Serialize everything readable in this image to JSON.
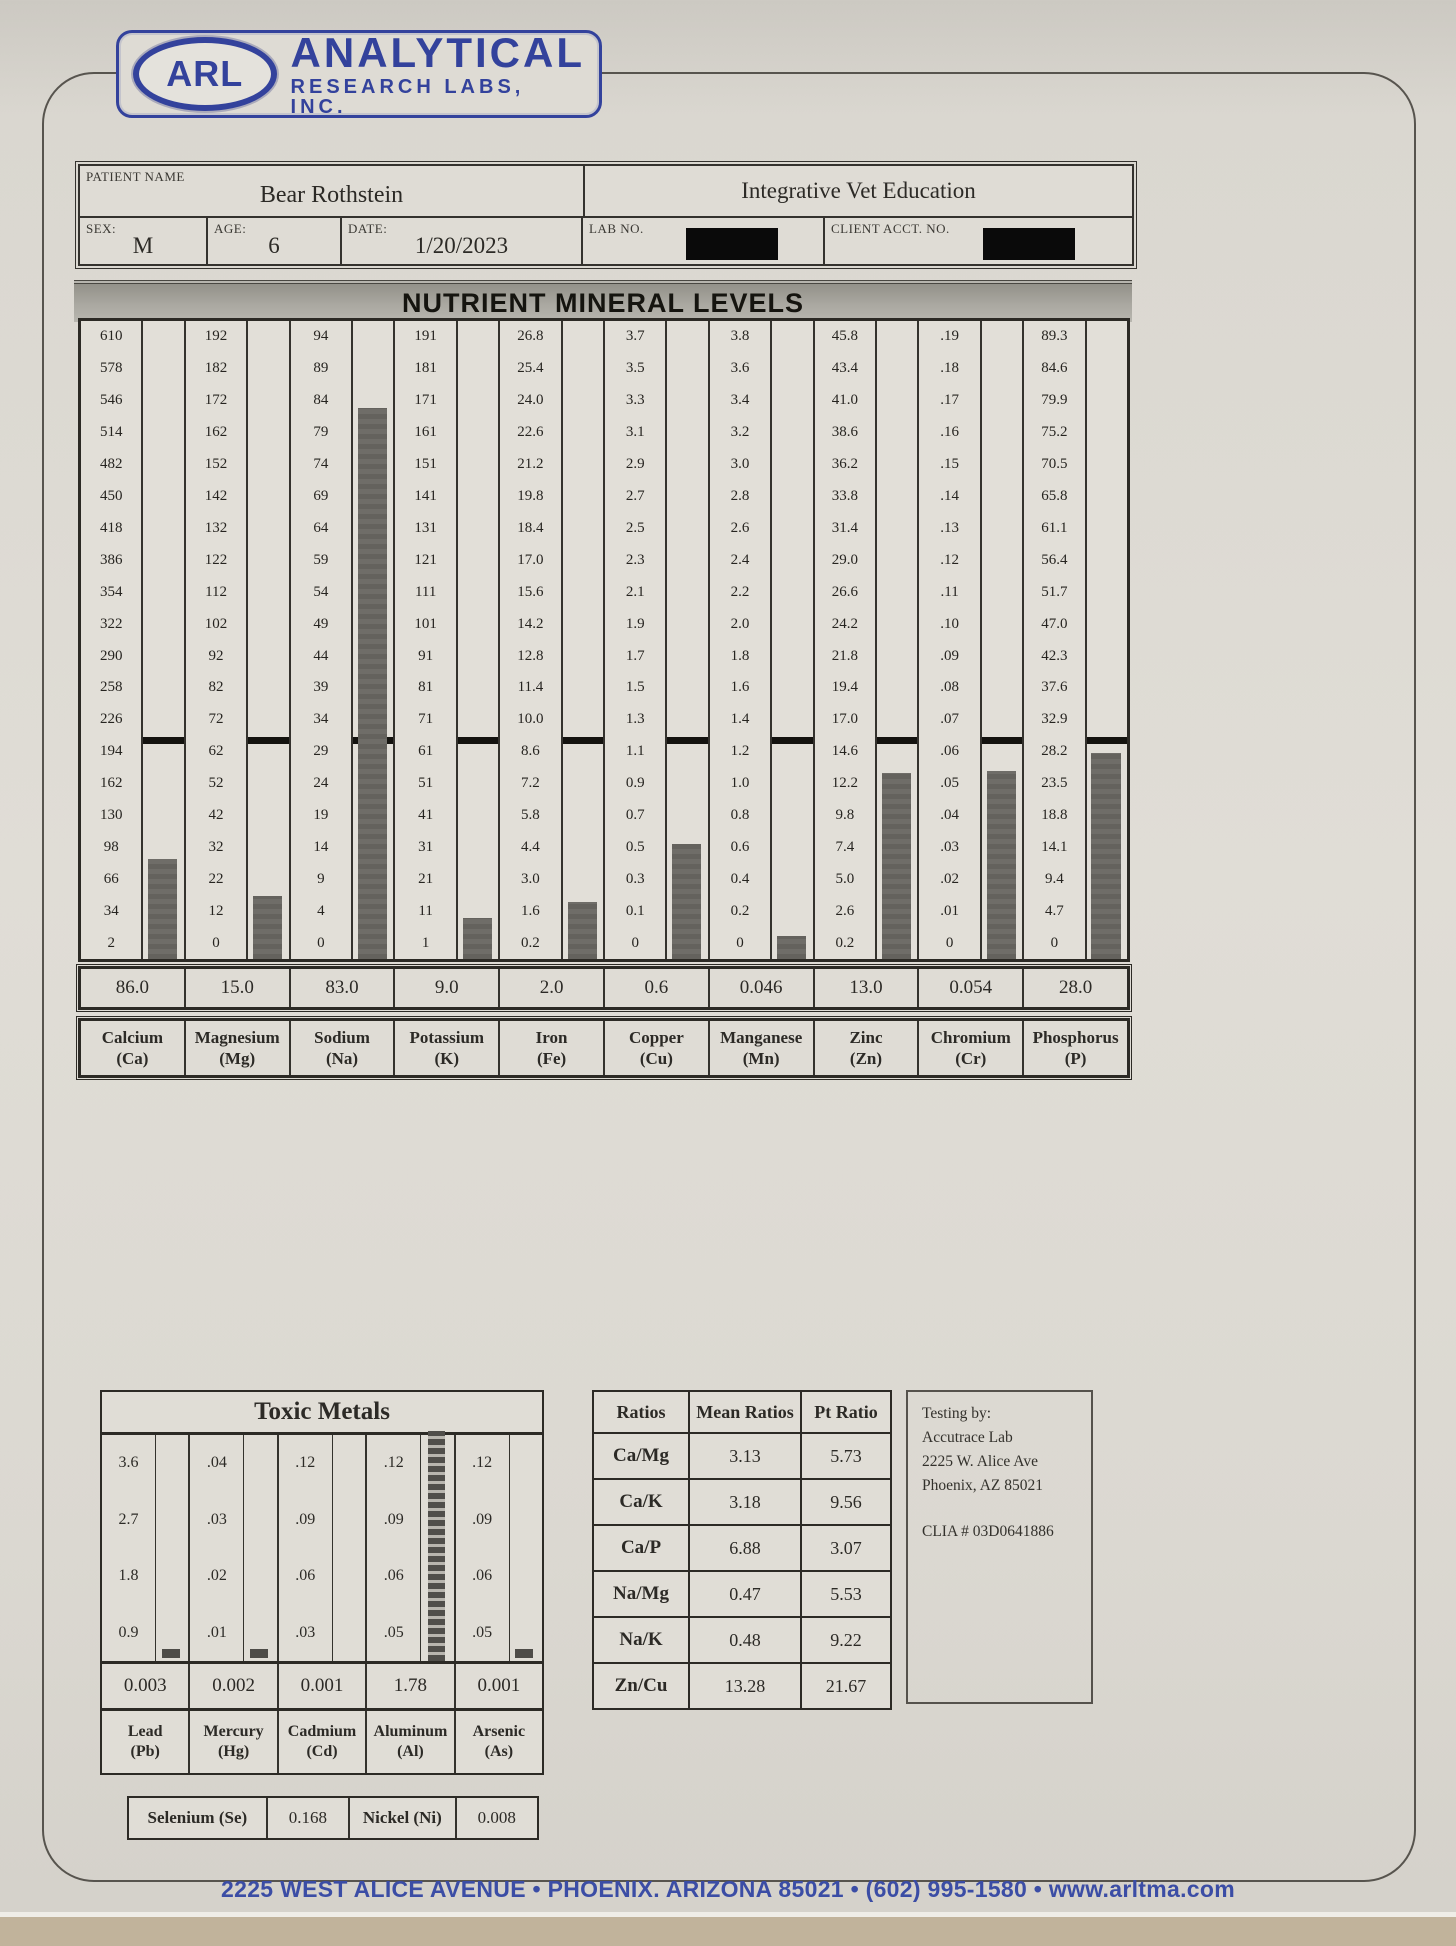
{
  "logo": {
    "badge": "ARL",
    "line1": "ANALYTICAL",
    "line2": "RESEARCH LABS, INC."
  },
  "patient": {
    "name_label": "PATIENT NAME",
    "name": "Bear Rothstein",
    "clinic": "Integrative Vet Education",
    "sex_label": "SEX:",
    "sex": "M",
    "age_label": "AGE:",
    "age": "6",
    "date_label": "DATE:",
    "date": "1/20/2023",
    "lab_no_label": "LAB NO.",
    "client_acct_label": "CLIENT ACCT. NO."
  },
  "chart_data": [
    {
      "type": "bar",
      "title": "NUTRIENT MINERAL LEVELS",
      "legend_position": "none",
      "grid": false,
      "ideal_row_index": 13,
      "categories": [
        "Calcium (Ca)",
        "Magnesium (Mg)",
        "Sodium (Na)",
        "Potassium (K)",
        "Iron (Fe)",
        "Copper (Cu)",
        "Manganese (Mn)",
        "Zinc (Zn)",
        "Chromium (Cr)",
        "Phosphorus (P)"
      ],
      "values": [
        86.0,
        15.0,
        83.0,
        9.0,
        2.0,
        0.6,
        0.046,
        13.0,
        0.054,
        28.0
      ],
      "columns": [
        {
          "name": "Calcium",
          "symbol": "(Ca)",
          "value_label": "86.0",
          "scale": [
            "610",
            "578",
            "546",
            "514",
            "482",
            "450",
            "418",
            "386",
            "354",
            "322",
            "290",
            "258",
            "226",
            "194",
            "162",
            "130",
            "98",
            "66",
            "34",
            "2"
          ]
        },
        {
          "name": "Magnesium",
          "symbol": "(Mg)",
          "value_label": "15.0",
          "scale": [
            "192",
            "182",
            "172",
            "162",
            "152",
            "142",
            "132",
            "122",
            "112",
            "102",
            "92",
            "82",
            "72",
            "62",
            "52",
            "42",
            "32",
            "22",
            "12",
            "0"
          ]
        },
        {
          "name": "Sodium",
          "symbol": "(Na)",
          "value_label": "83.0",
          "scale": [
            "94",
            "89",
            "84",
            "79",
            "74",
            "69",
            "64",
            "59",
            "54",
            "49",
            "44",
            "39",
            "34",
            "29",
            "24",
            "19",
            "14",
            "9",
            "4",
            "0"
          ]
        },
        {
          "name": "Potassium",
          "symbol": "(K)",
          "value_label": "9.0",
          "scale": [
            "191",
            "181",
            "171",
            "161",
            "151",
            "141",
            "131",
            "121",
            "111",
            "101",
            "91",
            "81",
            "71",
            "61",
            "51",
            "41",
            "31",
            "21",
            "11",
            "1"
          ]
        },
        {
          "name": "Iron",
          "symbol": "(Fe)",
          "value_label": "2.0",
          "scale": [
            "26.8",
            "25.4",
            "24.0",
            "22.6",
            "21.2",
            "19.8",
            "18.4",
            "17.0",
            "15.6",
            "14.2",
            "12.8",
            "11.4",
            "10.0",
            "8.6",
            "7.2",
            "5.8",
            "4.4",
            "3.0",
            "1.6",
            "0.2"
          ]
        },
        {
          "name": "Copper",
          "symbol": "(Cu)",
          "value_label": "0.6",
          "scale": [
            "3.7",
            "3.5",
            "3.3",
            "3.1",
            "2.9",
            "2.7",
            "2.5",
            "2.3",
            "2.1",
            "1.9",
            "1.7",
            "1.5",
            "1.3",
            "1.1",
            "0.9",
            "0.7",
            "0.5",
            "0.3",
            "0.1",
            "0"
          ]
        },
        {
          "name": "Manganese",
          "symbol": "(Mn)",
          "value_label": "0.046",
          "scale": [
            "3.8",
            "3.6",
            "3.4",
            "3.2",
            "3.0",
            "2.8",
            "2.6",
            "2.4",
            "2.2",
            "2.0",
            "1.8",
            "1.6",
            "1.4",
            "1.2",
            "1.0",
            "0.8",
            "0.6",
            "0.4",
            "0.2",
            "0"
          ]
        },
        {
          "name": "Zinc",
          "symbol": "(Zn)",
          "value_label": "13.0",
          "scale": [
            "45.8",
            "43.4",
            "41.0",
            "38.6",
            "36.2",
            "33.8",
            "31.4",
            "29.0",
            "26.6",
            "24.2",
            "21.8",
            "19.4",
            "17.0",
            "14.6",
            "12.2",
            "9.8",
            "7.4",
            "5.0",
            "2.6",
            "0.2"
          ]
        },
        {
          "name": "Chromium",
          "symbol": "(Cr)",
          "value_label": "0.054",
          "scale": [
            ".19",
            ".18",
            ".17",
            ".16",
            ".15",
            ".14",
            ".13",
            ".12",
            ".11",
            ".10",
            ".09",
            ".08",
            ".07",
            ".06",
            ".05",
            ".04",
            ".03",
            ".02",
            ".01",
            "0"
          ]
        },
        {
          "name": "Phosphorus",
          "symbol": "(P)",
          "value_label": "28.0",
          "scale": [
            "89.3",
            "84.6",
            "79.9",
            "75.2",
            "70.5",
            "65.8",
            "61.1",
            "56.4",
            "51.7",
            "47.0",
            "42.3",
            "37.6",
            "32.9",
            "28.2",
            "23.5",
            "18.8",
            "14.1",
            "9.4",
            "4.7",
            "0"
          ]
        }
      ]
    },
    {
      "type": "bar",
      "title": "Toxic Metals",
      "categories": [
        "Lead (Pb)",
        "Mercury (Hg)",
        "Cadmium (Cd)",
        "Aluminum (Al)",
        "Arsenic (As)"
      ],
      "values": [
        0.003,
        0.002,
        0.001,
        1.78,
        0.001
      ],
      "columns": [
        {
          "name": "Lead",
          "symbol": "(Pb)",
          "value_label": "0.003",
          "scale": [
            "3.6",
            "2.7",
            "1.8",
            "0.9"
          ],
          "bar": "small"
        },
        {
          "name": "Mercury",
          "symbol": "(Hg)",
          "value_label": "0.002",
          "scale": [
            ".04",
            ".03",
            ".02",
            ".01"
          ],
          "bar": "small"
        },
        {
          "name": "Cadmium",
          "symbol": "(Cd)",
          "value_label": "0.001",
          "scale": [
            ".12",
            ".09",
            ".06",
            ".03"
          ],
          "bar": "none"
        },
        {
          "name": "Aluminum",
          "symbol": "(Al)",
          "value_label": "1.78",
          "scale": [
            ".12",
            ".09",
            ".06",
            ".05"
          ],
          "bar": "full"
        },
        {
          "name": "Arsenic",
          "symbol": "(As)",
          "value_label": "0.001",
          "scale": [
            ".12",
            ".09",
            ".06",
            ".05"
          ],
          "bar": "small"
        }
      ],
      "extra_rows": [
        {
          "label": "Selenium (Se)",
          "value": "0.168"
        },
        {
          "label": "Nickel (Ni)",
          "value": "0.008"
        }
      ]
    }
  ],
  "ratios": {
    "headers": [
      "Ratios",
      "Mean Ratios",
      "Pt Ratio"
    ],
    "rows": [
      [
        "Ca/Mg",
        "3.13",
        "5.73"
      ],
      [
        "Ca/K",
        "3.18",
        "9.56"
      ],
      [
        "Ca/P",
        "6.88",
        "3.07"
      ],
      [
        "Na/Mg",
        "0.47",
        "5.53"
      ],
      [
        "Na/K",
        "0.48",
        "9.22"
      ],
      [
        "Zn/Cu",
        "13.28",
        "21.67"
      ]
    ]
  },
  "testing_by": {
    "lines": [
      "Testing by:",
      "Accutrace Lab",
      "2225 W. Alice Ave",
      "Phoenix, AZ 85021",
      "",
      "CLIA # 03D0641886"
    ]
  },
  "footer": "2225 WEST ALICE AVENUE • PHOENIX. ARIZONA 85021 • (602) 995-1580 • www.arltma.com"
}
